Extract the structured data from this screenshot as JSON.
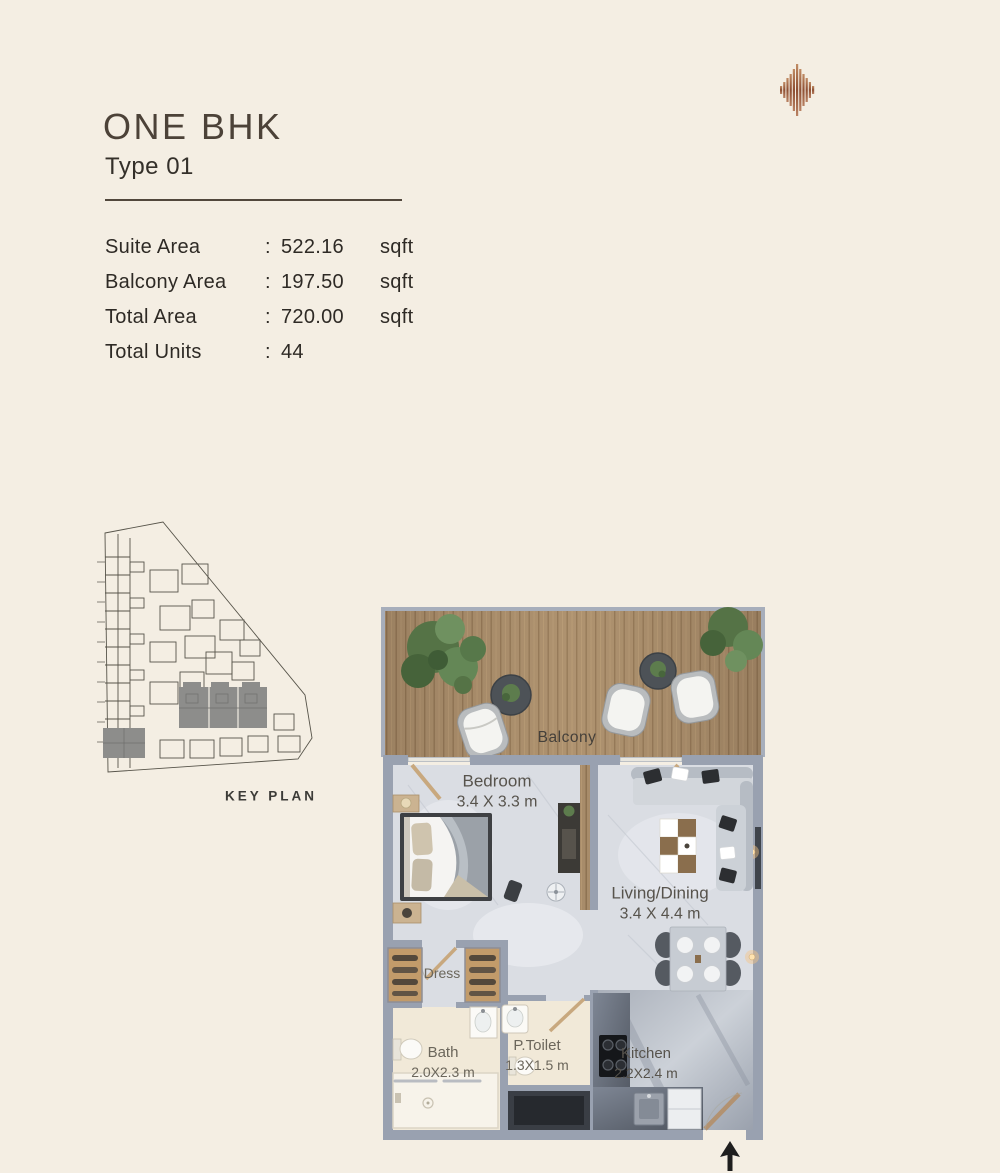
{
  "header": {
    "title": "ONE BHK",
    "subtitle": "Type 01"
  },
  "stats": {
    "rows": [
      {
        "label": "Suite Area",
        "colon": ":",
        "value": "522.16",
        "unit": "sqft"
      },
      {
        "label": "Balcony Area",
        "colon": ":",
        "value": "197.50",
        "unit": "sqft"
      },
      {
        "label": "Total Area",
        "colon": ":",
        "value": "720.00",
        "unit": "sqft"
      },
      {
        "label": "Total Units",
        "colon": ":",
        "value": "44",
        "unit": ""
      }
    ]
  },
  "keyplan": {
    "label": "KEY PLAN"
  },
  "plan": {
    "balcony": {
      "name": "Balcony"
    },
    "bedroom": {
      "name": "Bedroom",
      "dims": "3.4 X 3.3 m"
    },
    "living": {
      "name": "Living/Dining",
      "dims": "3.4 X 4.4 m"
    },
    "dress": {
      "name": "Dress"
    },
    "bath": {
      "name": "Bath",
      "dims": "2.0X2.3 m"
    },
    "ptoilet": {
      "name": "P.Toilet",
      "dims": "1.3X1.5 m"
    },
    "kitchen": {
      "name": "Kitchen",
      "dims": "2.2X2.4 m"
    }
  },
  "colors": {
    "background": "#f4eee3",
    "title_text": "#4c4238",
    "body_text": "#2e2a25",
    "logo_copper": "#a96e4c",
    "wall_gray": "#9aa3b2",
    "deck_wood": "#a88c6a",
    "keyplan_highlight": "#8d8d8b",
    "bath_floor": "#f1e9d8",
    "marble_floor": "#dadde3"
  }
}
